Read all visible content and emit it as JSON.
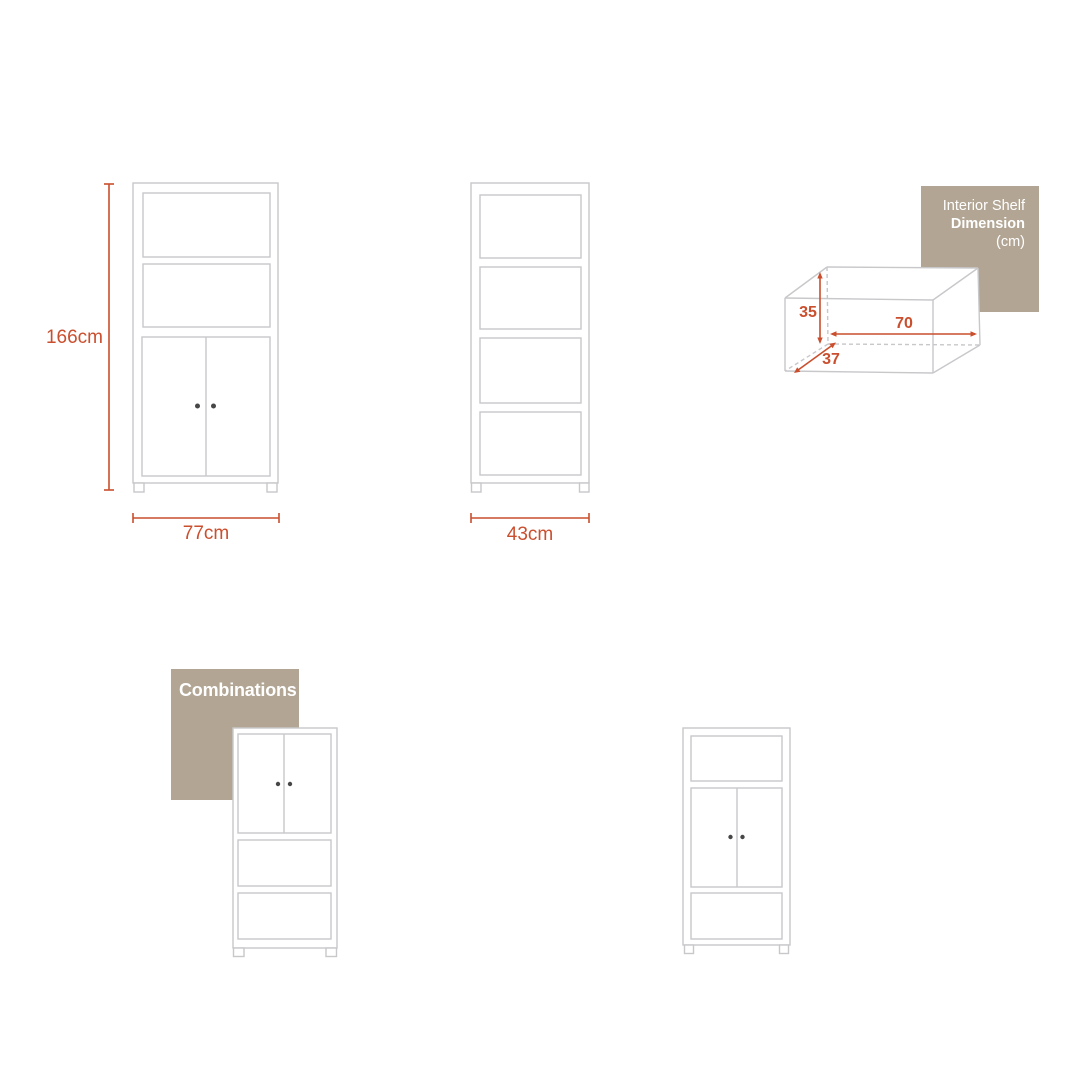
{
  "colors": {
    "accent": "#ca4f2e",
    "drawing_line": "#c8c8cb",
    "label_bg": "#b2a593",
    "label_text": "#ffffff",
    "handle_dot": "#474747"
  },
  "front_view": {
    "height_label": "166cm",
    "width_label": "77cm"
  },
  "side_view": {
    "width_label": "43cm"
  },
  "interior_shelf": {
    "label_line1": "Interior Shelf",
    "label_line2": "Dimension",
    "label_line3": "(cm)",
    "height_value": "35",
    "width_value": "70",
    "depth_value": "37"
  },
  "combinations": {
    "label": "Combinations"
  }
}
